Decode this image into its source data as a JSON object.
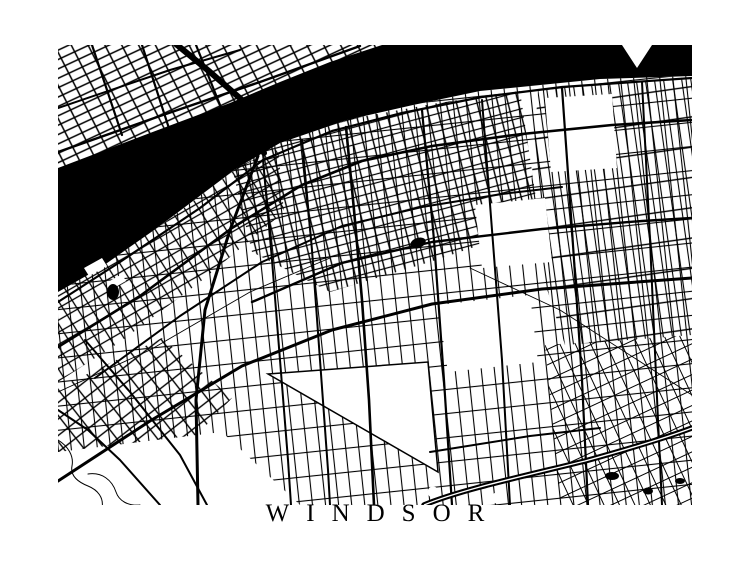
{
  "title": "WINDSOR",
  "colors": {
    "ink": "#000000",
    "paper": "#ffffff"
  }
}
